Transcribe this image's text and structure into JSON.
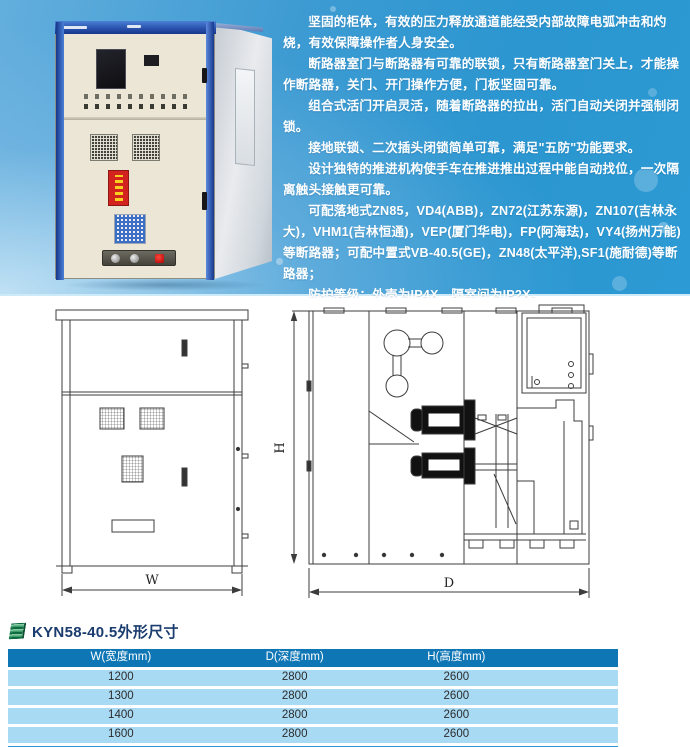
{
  "colors": {
    "hero_blue_deep": "#2b96d0",
    "hero_blue_light": "#a8d8ef",
    "cabinet_blue": "#2356ae",
    "table_header_bg": "#0f76b5",
    "table_row_bg": "#a9daf4",
    "table_bottom_strip": "#2e98d4",
    "title_color": "#1a3c6e",
    "feature_text_color": "#ffffff"
  },
  "features": {
    "paragraphs": [
      "坚固的柜体，有效的压力释放通道能经受内部故障电弧冲击和灼烧，有效保障操作者人身安全。",
      "断路器室门与断路器有可靠的联锁，只有断路器室门关上，才能操作断路器，关门、开门操作方便，门板坚固可靠。",
      "组合式活门开启灵活，随着断路器的拉出，活门自动关闭并强制闭锁。",
      "接地联锁、二次插头闭锁简单可靠，满足\"五防\"功能要求。",
      "设计独特的推进机构使手车在推进推出过程中能自动找位，一次隔离触头接触更可靠。",
      "可配落地式ZN85，VD4(ABB)，ZN72(江苏东源)，ZN107(吉林永大)，VHM1(吉林恒通)，VEP(厦门华电)，FP(阿海珐)，VY4(扬州万能)等断路器；可配中置式VB-40.5(GE)，ZN48(太平洋),SF1(施耐德)等断路器；",
      "防护等级：外壳为IP4X，隔室间为IP2X。"
    ]
  },
  "drawings": {
    "front_view": {
      "width_label": "W"
    },
    "side_view": {
      "height_label": "H",
      "depth_label": "D"
    }
  },
  "dimensions": {
    "title": "KYN58-40.5外形尺寸",
    "table": {
      "headers": [
        "W(宽度mm)",
        "D(深度mm)",
        "H(高度mm)"
      ],
      "rows": [
        [
          "1200",
          "2800",
          "2600"
        ],
        [
          "1300",
          "2800",
          "2600"
        ],
        [
          "1400",
          "2800",
          "2600"
        ],
        [
          "1600",
          "2800",
          "2600"
        ]
      ]
    }
  }
}
